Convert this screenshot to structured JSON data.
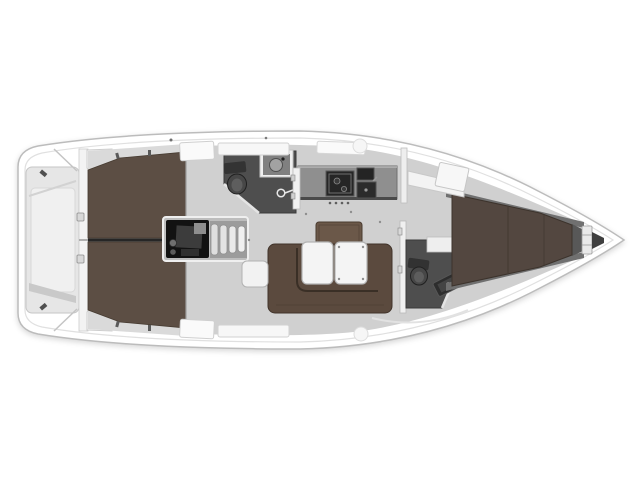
{
  "plan": {
    "title": "Sailing yacht interior layout plan, top view, bow pointing right",
    "orientation": {
      "bow_side": "right",
      "stern_side": "left"
    },
    "areas": [
      {
        "id": "swim-platform",
        "label": "Transom / swim platform"
      },
      {
        "id": "aft-cabin-port",
        "label": "Aft cabin (port)"
      },
      {
        "id": "aft-cabin-starboard",
        "label": "Aft cabin (starboard)"
      },
      {
        "id": "engine-compartment",
        "label": "Engine compartment"
      },
      {
        "id": "companionway-steps",
        "label": "Companionway steps"
      },
      {
        "id": "aft-head",
        "label": "Aft head / WC"
      },
      {
        "id": "galley",
        "label": "Galley"
      },
      {
        "id": "saloon",
        "label": "Saloon with U-settee and folding table"
      },
      {
        "id": "forward-head",
        "label": "Forward head / WC"
      },
      {
        "id": "forward-cabin",
        "label": "Forward V-berth cabin"
      },
      {
        "id": "anchor-locker",
        "label": "Bow / anchor locker"
      }
    ],
    "colors": {
      "background": "#ffffff",
      "hull_fill": "#ffffff",
      "hull_stroke": "#bcbcbc",
      "inner_line": "#e0e0e0",
      "deck_white": "#f7f7f7",
      "floor_gray": "#d0d0d0",
      "band_gray": "#dadada",
      "platform_gray": "#e6e6e6",
      "cabin_wood": "#5c4e44",
      "forward_wood": "#534740",
      "settee_wood": "#5b4a3e",
      "bench_wood": "#6b5849",
      "head_floor": "#4e4e4e",
      "head_wall": "#e4e4e4",
      "counter_gray": "#8f8f8f",
      "appliance_black": "#262626",
      "engine_black": "#121212",
      "tread_light": "#dedede",
      "table_white": "#f4f4f4",
      "furniture_white": "#f2f2f2",
      "fixture_gray": "#474747",
      "divider_dark": "#262626",
      "shelf_gray": "#707070"
    }
  }
}
